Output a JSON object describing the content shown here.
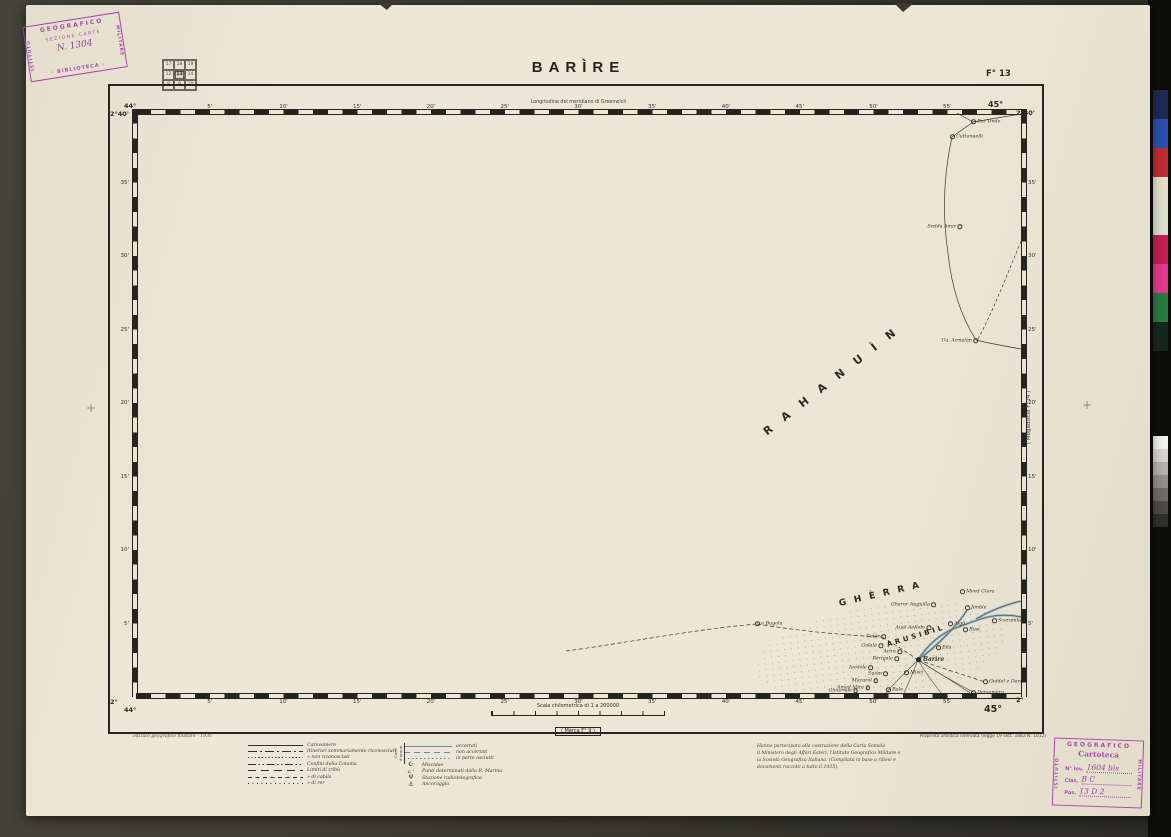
{
  "header": {
    "title": "BARÌRE",
    "sheet": "F° 13",
    "longitude_note": "Longitudine del meridiano di Greenwich",
    "index_grid": {
      "rows": [
        [
          "17",
          "18",
          "19"
        ],
        [
          "12",
          "13",
          "14"
        ],
        [
          "8",
          "9",
          "10"
        ]
      ],
      "highlighted": "13"
    }
  },
  "frame": {
    "corners": {
      "tl_lat": "2°40'",
      "tl_lon": "44°",
      "tr_lon": "45°",
      "tr_lat": "2°40'",
      "bl_lat": "2°",
      "bl_lon": "44°",
      "br_lon": "45°",
      "br_lat": "2°"
    },
    "top_ticks": [
      "5'",
      "10'",
      "15'",
      "20'",
      "25'",
      "30'",
      "35'",
      "40'",
      "45'",
      "50'",
      "55'"
    ],
    "bottom_ticks": [
      "5'",
      "10'",
      "15'",
      "20'",
      "25'",
      "30'",
      "35'",
      "40'",
      "45'",
      "50'",
      "55'"
    ],
    "left_ticks": [
      "35'",
      "30'",
      "25'",
      "20'",
      "15'",
      "10'",
      "5'"
    ],
    "right_ticks": [
      "35'",
      "30'",
      "25'",
      "20'",
      "15'",
      "10'",
      "5'"
    ],
    "adjacent_sheet_right": "( Mogadiscio F°14 )",
    "adjacent_sheet_bottom": "( Mèrca F° 9 )"
  },
  "scale": {
    "title": "Scala chilometrica di 1 a 200000"
  },
  "map": {
    "regions": [
      {
        "n": "RAHANUÌN",
        "x": 699,
        "y": 265,
        "rot": -38,
        "ls": 14,
        "fs": 11
      },
      {
        "n": "GHÈRRA",
        "x": 747,
        "y": 481,
        "rot": -13,
        "ls": 8,
        "fs": 9
      },
      {
        "n": "ARUSIBIL",
        "x": 780,
        "y": 523,
        "rot": -17,
        "ls": 3,
        "fs": 7
      }
    ],
    "places": [
      {
        "n": "Bur Onde",
        "x": 837,
        "y": 9
      },
      {
        "n": "Cuttanaelli",
        "x": 816,
        "y": 24
      },
      {
        "n": "Sedda Amìr",
        "x": 822,
        "y": 114,
        "side": "l"
      },
      {
        "n": "Ua. Armalàn",
        "x": 838,
        "y": 228,
        "side": "l"
      },
      {
        "n": "Meed Clora",
        "x": 826,
        "y": 479
      },
      {
        "n": "Gherer Auguilla",
        "x": 796,
        "y": 492,
        "side": "l"
      },
      {
        "n": "Jimble",
        "x": 831,
        "y": 495
      },
      {
        "n": "Sceramba Camar",
        "x": 858,
        "y": 508
      },
      {
        "n": "Aual Aofàdo",
        "x": 791,
        "y": 515,
        "side": "l"
      },
      {
        "n": "Aigò",
        "x": 814,
        "y": 511
      },
      {
        "n": "Rùsi",
        "x": 829,
        "y": 517
      },
      {
        "n": "Eila",
        "x": 802,
        "y": 535
      },
      {
        "n": "Catâr",
        "x": 746,
        "y": 524,
        "side": "l"
      },
      {
        "n": "Galalà",
        "x": 743,
        "y": 533,
        "side": "l"
      },
      {
        "n": "e Bugola",
        "x": 621,
        "y": 511
      },
      {
        "n": "Arirà",
        "x": 762,
        "y": 539,
        "side": "l"
      },
      {
        "n": "Rerìgale",
        "x": 759,
        "y": 546,
        "side": "l"
      },
      {
        "n": "Barìre",
        "x": 782,
        "y": 547,
        "major": true
      },
      {
        "n": "Iacdòle",
        "x": 733,
        "y": 555,
        "side": "l"
      },
      {
        "n": "Suiàn",
        "x": 748,
        "y": 561,
        "side": "l"
      },
      {
        "n": "Miscì",
        "x": 770,
        "y": 560
      },
      {
        "n": "Macaròl",
        "x": 738,
        "y": 568,
        "side": "l"
      },
      {
        "n": "Amed Mira",
        "x": 730,
        "y": 575,
        "side": "l"
      },
      {
        "n": "Ghiurrale",
        "x": 718,
        "y": 578,
        "side": "l"
      },
      {
        "n": "Bale",
        "x": 752,
        "y": 577
      },
      {
        "n": "Giddel e Daradorle",
        "x": 849,
        "y": 569
      },
      {
        "n": "Dersamèra",
        "x": 837,
        "y": 580
      }
    ]
  },
  "legend": {
    "edition_note": "Istituto geografico militare - 1936",
    "routes": [
      {
        "style": "solid",
        "label": "Carovaniere"
      },
      {
        "style": "dashdot",
        "label": "Itinerari sommariamente riconosciuti"
      },
      {
        "style": "dotted",
        "label": "»    non riconosciuti"
      },
      {
        "style": "dashdotdot",
        "label": "Confini della Colonia"
      },
      {
        "style": "longdash",
        "label": "Limiti di tribù"
      },
      {
        "style": "shortdash",
        "label": "»    di cabila"
      },
      {
        "style": "finedot",
        "label": "»    di rer"
      }
    ],
    "water_label": "Corsi d'acqua",
    "water": [
      {
        "style": "solid",
        "label": "accertati"
      },
      {
        "style": "dashed",
        "label": "non accertati"
      },
      {
        "style": "dotted",
        "label": "in parte asciutti"
      }
    ],
    "symbols": [
      {
        "glyph": "☪",
        "label": "Miscidas"
      },
      {
        "glyph": "▵ ·",
        "label": "Punti determinati dalla R. Marina"
      },
      {
        "glyph": "Ψ",
        "label": "Stazione radiotelegrafica"
      },
      {
        "glyph": "⚓",
        "label": "Ancoraggio"
      }
    ]
  },
  "credits": {
    "copyright": "Proprietà artistica riservata (legge 19 sett. 1882  N. 1012)",
    "note_lines": [
      "Hanno partecipato alla costruzione della Carta Somala",
      "il Ministero degli Affari Esteri, l'Istituto Geografico Militare e",
      "la Società Geografica Italiana. (Compilata in base a rilievi e",
      "documenti raccolti a tutto il 1935)."
    ]
  },
  "stamps": {
    "library": {
      "side_left": "ISTITUTO",
      "top": "GEOGRAFICO",
      "side_right": "MILITARE",
      "row1": "SEZIONE CARTE",
      "number": "N. 1304",
      "bottom": "· BIBLIOTECA ·"
    },
    "cartoteca": {
      "side_left": "ISTITUTO",
      "top": "GEOGRAFICO",
      "side_right": "MILITARE",
      "title": "Cartoteca",
      "rows": [
        {
          "label": "N° inv.",
          "value": "1604 bis"
        },
        {
          "label": "Clas.",
          "value": "B C"
        },
        {
          "label": "Pos.",
          "value": "13 D 2"
        }
      ]
    }
  },
  "calibration": {
    "colors": [
      "#1c2b55",
      "#2b4fae",
      "#bf2b30",
      "#e2dcc8",
      "#d9decb",
      "#c22055",
      "#e23a8e",
      "#2c7a41",
      "#15271c"
    ],
    "grays": [
      "#f4f2ec",
      "#d4d2cc",
      "#b2b0aa",
      "#908e88",
      "#6e6c66",
      "#4c4a46",
      "#302f2c"
    ]
  },
  "colors": {
    "stamp": "#a03aa8",
    "water": "#5d8fb5",
    "ink": "#26241e",
    "paper": "#ece6d6"
  }
}
